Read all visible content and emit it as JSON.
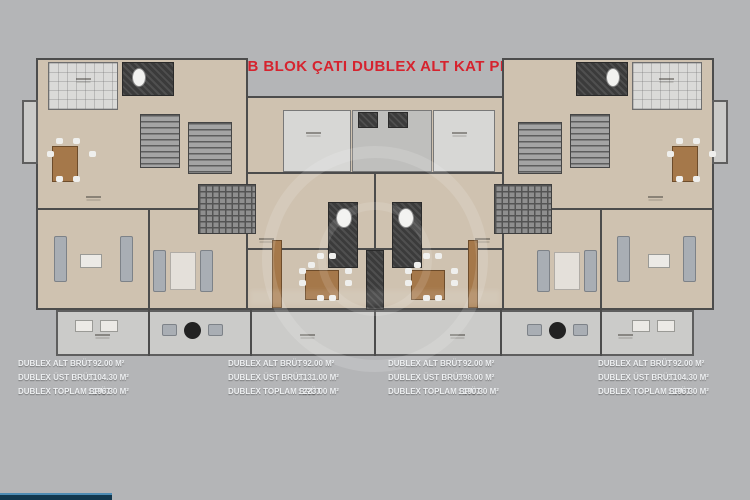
{
  "title": "B BLOK ÇATI DUBLEX ALT KAT PLANI",
  "colors": {
    "background": "#b4b5b7",
    "title_red": "#d6232e",
    "room_beige": "#cfc2b0",
    "terrace_gray": "#cbcbc9",
    "tile_light": "#dadad8",
    "wall_dark": "#4c4c4c",
    "wood_brown": "#a5784a",
    "progress_bar": "#12384f",
    "progress_bar_edge": "#4e8cb4"
  },
  "measurements": [
    {
      "rows": [
        {
          "label": "DUBLEX ALT BRÜT",
          "value": ": 92.00 M²"
        },
        {
          "label": "DUBLEX ÜST BRÜT",
          "value": ": 104.30 M²"
        },
        {
          "label": "DUBLEX TOPLAM BRÜT",
          "value": ": 196.30 M²"
        }
      ]
    },
    {
      "rows": [
        {
          "label": "DUBLEX ALT BRÜT",
          "value": ": 92.00 M²"
        },
        {
          "label": "DUBLEX ÜST BRÜT",
          "value": ": 131.00 M²"
        },
        {
          "label": "DUBLEX TOPLAM BRÜT",
          "value": ": 223.00 M²"
        }
      ]
    },
    {
      "rows": [
        {
          "label": "DUBLEX ALT BRÜT",
          "value": ": 92.00 M²"
        },
        {
          "label": "DUBLEX ÜST BRÜT",
          "value": ": 98.00 M²"
        },
        {
          "label": "DUBLEX TOPLAM BRÜT",
          "value": ": 190.30 M²"
        }
      ]
    },
    {
      "rows": [
        {
          "label": "DUBLEX ALT BRÜT",
          "value": ": 92.00 M²"
        },
        {
          "label": "DUBLEX ÜST BRÜT",
          "value": ": 104.30 M²"
        },
        {
          "label": "DUBLEX TOPLAM BRÜT",
          "value": ": 196.30 M²"
        }
      ]
    }
  ]
}
